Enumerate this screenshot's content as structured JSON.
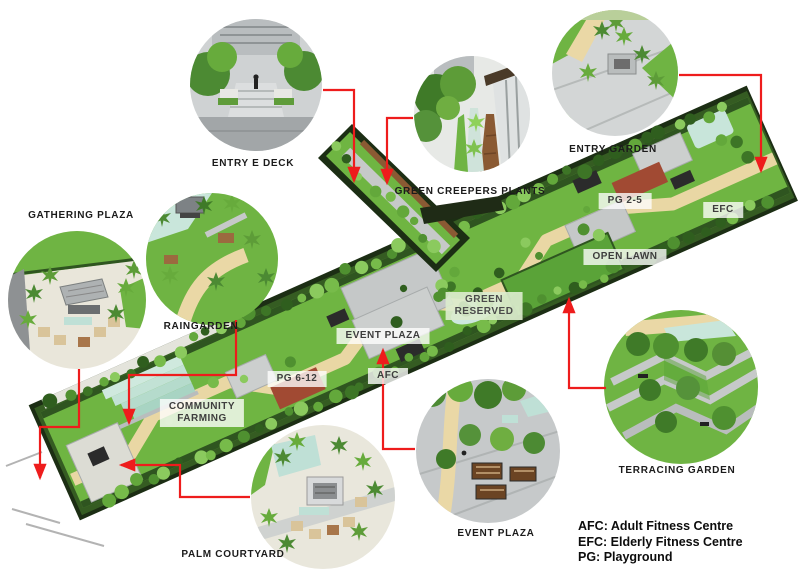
{
  "callouts": {
    "entry_e_deck": {
      "label": "ENTRY E DECK"
    },
    "green_creepers": {
      "label": "GREEN CREEPERS PLANTS"
    },
    "entry_garden": {
      "label": "ENTRY GARDEN"
    },
    "gathering_plaza": {
      "label": "GATHERING PLAZA"
    },
    "raingarden": {
      "label": "RAINGARDEN"
    },
    "palm_courtyard": {
      "label": "PALM COURTYARD"
    },
    "event_plaza": {
      "label": "EVENT PLAZA"
    },
    "terracing_garden": {
      "label": "TERRACING GARDEN"
    }
  },
  "plan_labels": {
    "pg_2_5": {
      "label": "PG 2-5"
    },
    "efc": {
      "label": "EFC"
    },
    "open_lawn": {
      "label": "OPEN LAWN"
    },
    "green_reserved": {
      "lines": [
        "GREEN",
        "RESERVED"
      ]
    },
    "event_plaza": {
      "label": "EVENT PLAZA"
    },
    "afc": {
      "label": "AFC"
    },
    "pg_6_12": {
      "label": "PG 6-12"
    },
    "community_farming": {
      "lines": [
        "COMMUNITY",
        "FARMING"
      ]
    }
  },
  "legend": {
    "items": [
      "AFC: Adult Fitness Centre",
      "EFC: Elderly Fitness Centre",
      "PG: Playground"
    ]
  },
  "colors": {
    "connector_red": "#ee1c1c",
    "lawn_green": "#6fb542",
    "dark_edge_green": "#1c2e14",
    "path_tan": "#e9d7a4",
    "water_teal": "#c9e6db",
    "paving_gray": "#c5c8c8",
    "playground_red": "#a14a33"
  }
}
